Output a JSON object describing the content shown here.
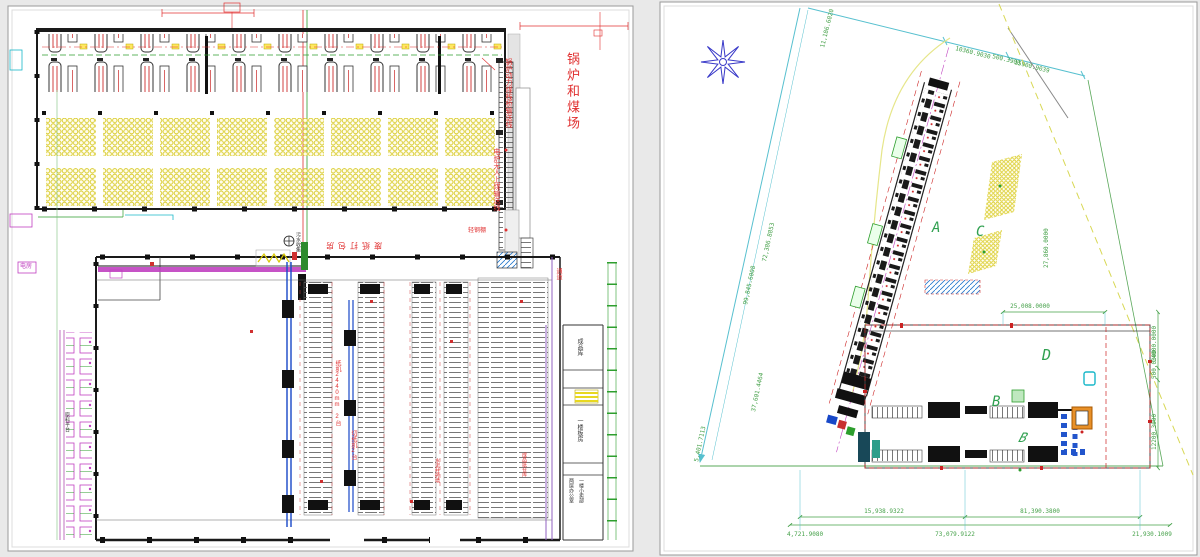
{
  "colors": {
    "annotation_red": "#e03030",
    "dimension_green": "#44a048",
    "boundary_cyan": "#57c0cf",
    "coil_yellow": "#d6c81e",
    "machine_magenta": "#c040c0",
    "conveyor_blue": "#1848c8",
    "zone_letter_green": "#30a050"
  },
  "left_plan": {
    "boiler_coal_yard": "锅炉和煤场",
    "coal_conveyor_1": "锅炉动力煤栈桥输送线",
    "coal_conveyor_2": "电炉无人上煤输送线",
    "waste_paper_baling": "废纸打包房",
    "sewage_collection": "污水收集",
    "light_steel_shed": "轻钢棚",
    "passage": "通道",
    "paper_machine": "纸机2440mm 2台",
    "paper_cutter": "切纸机2台",
    "cement_wall": "水泥柱砖墙",
    "finished_paper_warehouse": "成品纸仓库",
    "finished_goods_room": "成品库",
    "board_room": "一楼板房",
    "office_room": "两层办公室",
    "shop_room": "一楼小卖部",
    "material_platform": "原料平台",
    "power_room": "电房"
  },
  "site_plan": {
    "zones": {
      "a": "A",
      "b": "B",
      "b_italic": "B",
      "c": "C",
      "d": "D"
    },
    "dims": {
      "top_1": "10360.9030",
      "top_2": "500.3900",
      "top_3": "15900.9039",
      "upper_left": "11,186.6020",
      "west_outer": "99,845.6008",
      "west_inner": "72,386.8853",
      "west_mid": "37,601.4464",
      "west_low": "5,401.7113",
      "d_width": "25,008.0000",
      "c_east": "27,860.0000",
      "east_1": "14000.0000",
      "east_2": "500.0300",
      "east_3": "12200.3000",
      "south_a1": "15,938.9322",
      "south_a2": "81,390.3800",
      "south_b1": "4,721.9080",
      "south_b2": "73,079.9122",
      "south_b3": "21,930.1009"
    }
  }
}
